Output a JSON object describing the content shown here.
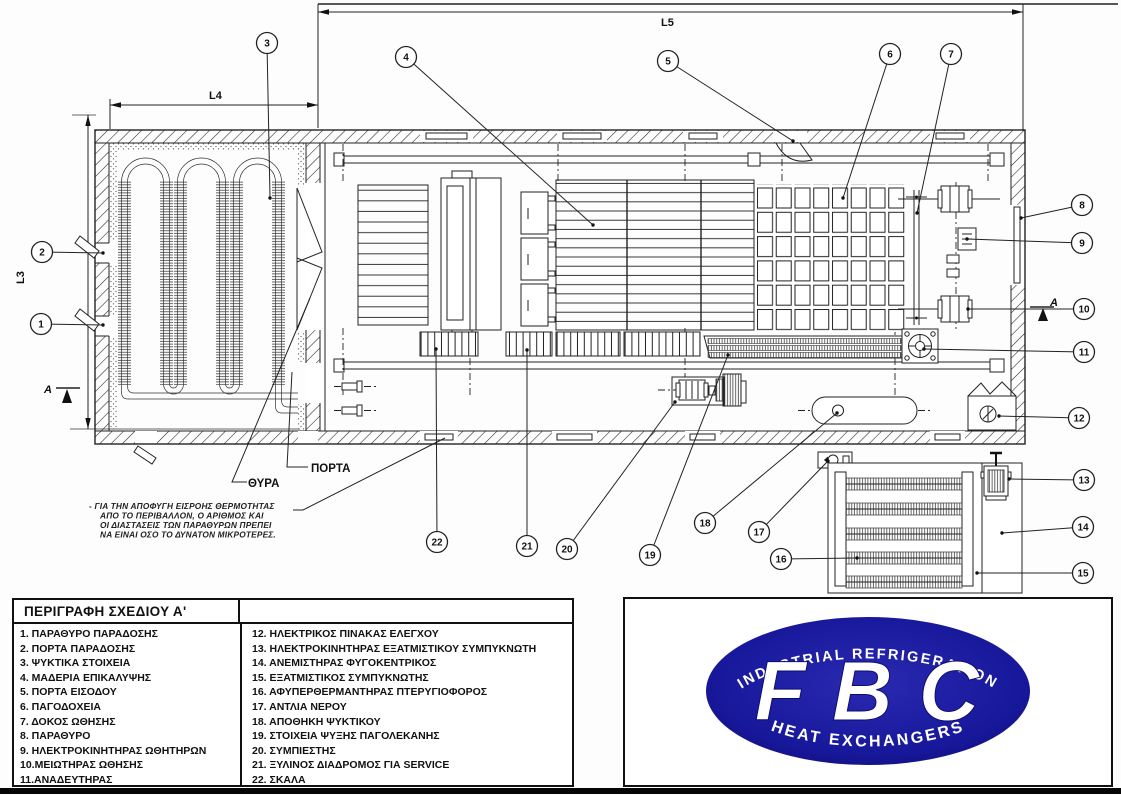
{
  "drawing": {
    "dims": {
      "l3": "L3",
      "l4": "L4",
      "l5": "L5"
    },
    "labels": {
      "thyra": "ΘΥΡΑ",
      "porta": "ΠΟΡΤΑ",
      "section_a": "A"
    },
    "note_lines": [
      "- ΓΙΑ ΤΗΝ ΑΠΟΦΥΓΗ ΕΙΣΡΟΗΣ ΘΕΡΜΟΤΗΤΑΣ",
      "ΑΠΟ ΤΟ ΠΕΡΙΒΑΛΛΟΝ, Ο ΑΡΙΘΜΟΣ ΚΑΙ",
      "ΟΙ ΔΙΑΣΤΑΣΕΙΣ ΤΩΝ ΠΑΡΑΘΥΡΩΝ ΠΡΕΠΕΙ",
      "ΝΑ ΕΙΝΑΙ ΟΣΟ ΤΟ ΔΥΝΑΤΟΝ ΜΙΚΡΟΤΕΡΕΣ."
    ],
    "callouts": [
      {
        "n": "1",
        "cx": 41,
        "cy": 324,
        "tx": 103,
        "ty": 325
      },
      {
        "n": "2",
        "cx": 42,
        "cy": 252,
        "tx": 103,
        "ty": 253
      },
      {
        "n": "3",
        "cx": 267,
        "cy": 43,
        "tx": 270,
        "ty": 198
      },
      {
        "n": "4",
        "cx": 406,
        "cy": 57,
        "tx": 593,
        "ty": 225
      },
      {
        "n": "5",
        "cx": 668,
        "cy": 61,
        "tx": 793,
        "ty": 141
      },
      {
        "n": "6",
        "cx": 890,
        "cy": 54,
        "tx": 843,
        "ty": 198
      },
      {
        "n": "7",
        "cx": 951,
        "cy": 54,
        "tx": 917,
        "ty": 213
      },
      {
        "n": "8",
        "cx": 1082,
        "cy": 205,
        "tx": 1021,
        "ty": 218
      },
      {
        "n": "9",
        "cx": 1082,
        "cy": 243,
        "tx": 967,
        "ty": 239
      },
      {
        "n": "10",
        "cx": 1084,
        "cy": 309,
        "tx": 968,
        "ty": 309
      },
      {
        "n": "11",
        "cx": 1084,
        "cy": 352,
        "tx": 924,
        "ty": 349
      },
      {
        "n": "12",
        "cx": 1079,
        "cy": 418,
        "tx": 999,
        "ty": 416
      },
      {
        "n": "13",
        "cx": 1084,
        "cy": 480,
        "tx": 1009,
        "ty": 479
      },
      {
        "n": "14",
        "cx": 1083,
        "cy": 527,
        "tx": 1002,
        "ty": 533
      },
      {
        "n": "15",
        "cx": 1083,
        "cy": 573,
        "tx": 977,
        "ty": 573
      },
      {
        "n": "16",
        "cx": 781,
        "cy": 559,
        "tx": 857,
        "ty": 558
      },
      {
        "n": "17",
        "cx": 759,
        "cy": 532,
        "tx": 828,
        "ty": 461
      },
      {
        "n": "18",
        "cx": 705,
        "cy": 523,
        "tx": 837,
        "ty": 413
      },
      {
        "n": "19",
        "cx": 650,
        "cy": 555,
        "tx": 728,
        "ty": 355
      },
      {
        "n": "20",
        "cx": 567,
        "cy": 549,
        "tx": 675,
        "ty": 402
      },
      {
        "n": "21",
        "cx": 527,
        "cy": 546,
        "tx": 527,
        "ty": 350
      },
      {
        "n": "22",
        "cx": 437,
        "cy": 542,
        "tx": 436,
        "ty": 349
      }
    ]
  },
  "legend": {
    "title": "ΠΕΡΙΓΡΑΦΗ ΣΧΕΔΙΟΥ Α'",
    "left_items": [
      "1. ΠΑΡΑΘΥΡΟ ΠΑΡΑΔΟΣΗΣ",
      "2. ΠΟΡΤΑ ΠΑΡΑΔΟΣΗΣ",
      "3. ΨΥΚΤΙΚΑ ΣΤΟΙΧΕΙΑ",
      "4. ΜΑΔΕΡΙΑ ΕΠΙΚΑΛΥΨΗΣ",
      "5. ΠΟΡΤΑ ΕΙΣΟΔΟΥ",
      "6. ΠΑΓΟΔΟΧΕΙΑ",
      "7. ΔΟΚΟΣ ΩΘΗΣΗΣ",
      "8. ΠΑΡΑΘΥΡΟ",
      "9. ΗΛΕΚΤΡΟΚΙΝΗΤΗΡΑΣ ΩΘΗΤΗΡΩΝ",
      "10.ΜΕΙΩΤΗΡΑΣ ΩΘΗΣΗΣ",
      "11.ΑΝΑΔΕΥΤΗΡΑΣ"
    ],
    "right_items": [
      "12. ΗΛΕΚΤΡΙΚΟΣ ΠΙΝΑΚΑΣ ΕΛΕΓΧΟΥ",
      "13. ΗΛΕΚΤΡΟΚΙΝΗΤΗΡΑΣ ΕΞΑΤΜΙΣΤΙΚΟΥ ΣΥΜΠΥΚΝΩΤΗ",
      "14. ΑΝΕΜΙΣΤΗΡΑΣ ΦΥΓΟΚΕΝΤΡΙΚΟΣ",
      "15. ΕΞΑΤΜΙΣΤΙΚΟΣ ΣΥΜΠΥΚΝΩΤΗΣ",
      "16. ΑΦΥΠΕΡΘΕΡΜΑΝΤΗΡΑΣ ΠΤΕΡΥΓΙΟΦΟΡΟΣ",
      "17. ΑΝΤΛΙΑ ΝΕΡΟΥ",
      "18. ΑΠΟΘΗΚΗ ΨΥΚΤΙΚΟΥ",
      "19. ΣΤΟΙΧΕΙΑ ΨΥΞΗΣ ΠΑΓΟΛΕΚΑΝΗΣ",
      "20. ΣΥΜΠΙΕΣΤΗΣ",
      "21. ΞΥΛΙΝΟΣ ΔΙΑΔΡΟΜΟΣ ΓΙΑ SERVICE",
      "22. ΣΚΑΛΑ"
    ]
  },
  "logo": {
    "top": "INDUSTRIAL REFRIGERATION",
    "main": "FBC",
    "bottom": "HEAT EXCHANGERS",
    "blue": "#17179a"
  }
}
